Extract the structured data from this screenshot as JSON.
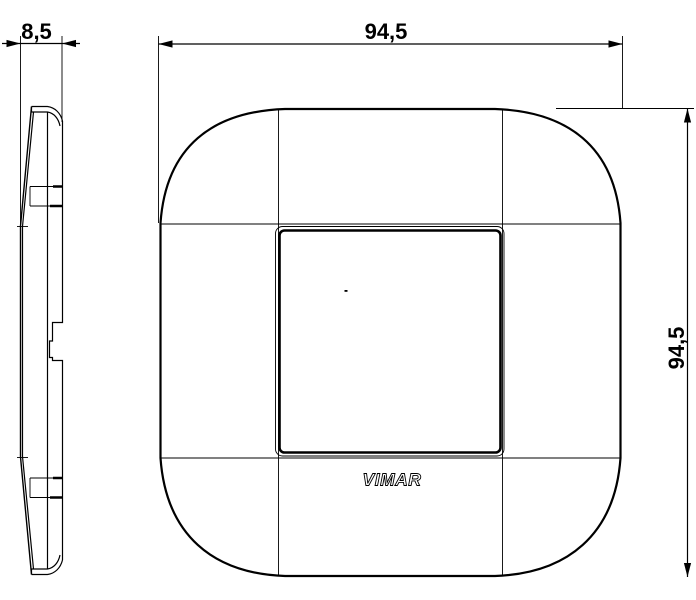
{
  "colors": {
    "line": "#000000",
    "background": "#ffffff"
  },
  "logo_text": "VIMAR",
  "dims": {
    "side_width": "8,5",
    "front_width": "94,5",
    "front_height": "94,5"
  }
}
